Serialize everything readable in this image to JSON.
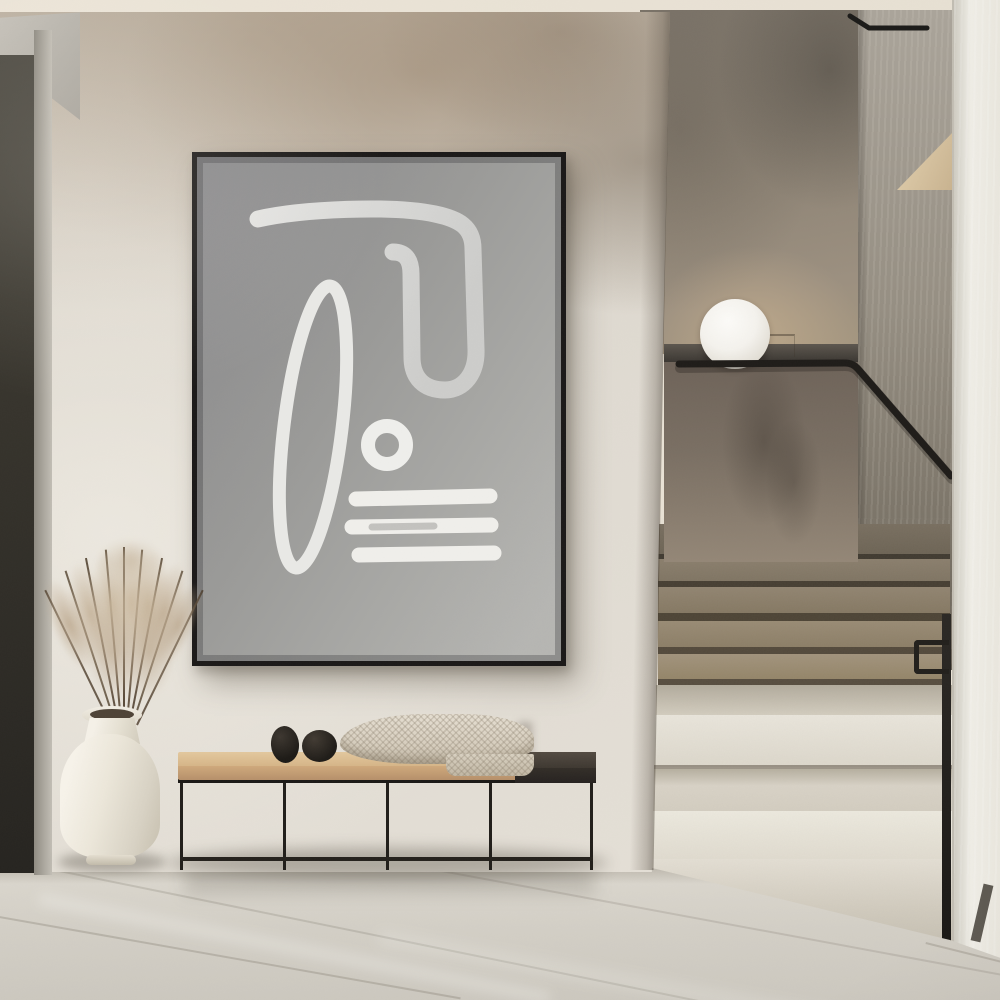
{
  "scene": {
    "label": "Minimalist hallway interior with framed abstract art, bench decor and a terrazzo staircase",
    "artwork": {
      "label": "Framed abstract line-art poster",
      "frame_color": "#1b1918",
      "canvas_color": "#9a9a98",
      "stroke_color": "#ebebe8",
      "shapes": [
        "hooked closed loop",
        "tall slanted oval outline",
        "small thick ring",
        "three horizontal brush strokes"
      ]
    },
    "bench": {
      "label": "Black metal frame bench with oak and espresso top",
      "seat_wood_color": "#d4b083",
      "seat_dark_color": "#443d35",
      "frame_color": "#211e1a",
      "sections": 4
    },
    "blanket": {
      "label": "Cream waffle-knit throw draped on bench",
      "color": "#d9d1c2"
    },
    "stones": {
      "label": "Two black decorative stone eggs",
      "color": "#242019"
    },
    "vase": {
      "label": "Cream ceramic floor vase",
      "color": "#efebe0"
    },
    "plant": {
      "label": "Dried pampas grass stems",
      "plume_color": "#bda88b",
      "stem_color": "#4a3a28",
      "stem_count": 11
    },
    "lamp": {
      "label": "White sphere lamp on stair parapet ledge",
      "color": "#f6f4ef"
    },
    "staircase": {
      "label": "Staircase with taupe upper steps and cream terrazzo lower platforms",
      "upper_step_color": "#94876f",
      "lower_step_color": "#e8e4da",
      "parapet_color": "#7c7164",
      "handrail_color": "#1f1d1a",
      "upper_steps": 5,
      "lower_platforms": 3
    },
    "walls": {
      "main_wall_color": "#ddd8cf",
      "mottle_color": "#a3917b",
      "niche_wall_color": "#958a7c",
      "streak_wall_color": "#9a937f",
      "right_column_color": "#eceae3",
      "ceiling_color": "#eae3d6",
      "left_panel_color": "#33302a",
      "niche_wedge_color": "#d8c5a6"
    },
    "floor": {
      "label": "Large-format light stone tile floor",
      "color": "#d5d1c8"
    }
  }
}
